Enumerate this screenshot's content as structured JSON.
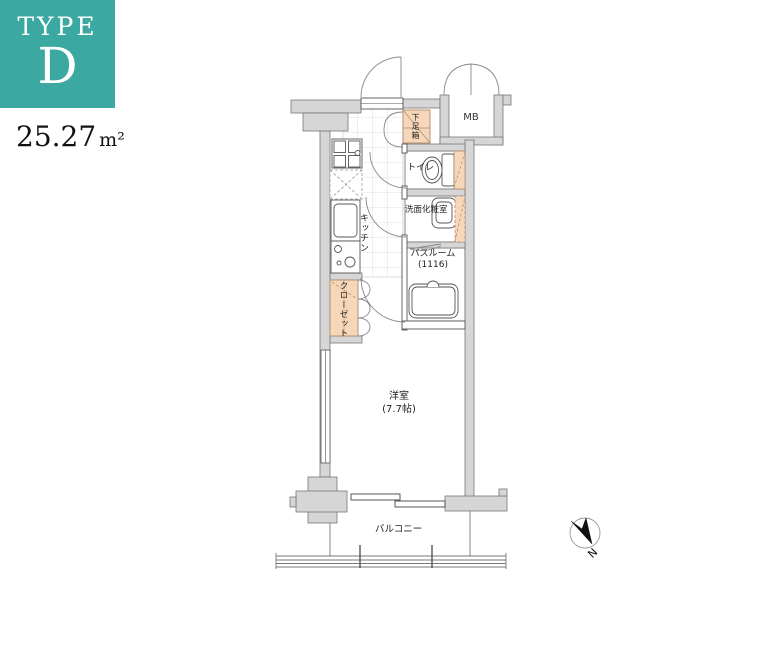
{
  "badge": {
    "type_label": "TYPE",
    "type_letter": "D"
  },
  "area": {
    "value": "25.27",
    "unit": "m²"
  },
  "rooms": {
    "shoe_box": "下足箱",
    "meter_box": "MB",
    "toilet": "トイレ",
    "washroom": "洗面化粧室",
    "kitchen": "キッチン",
    "bathroom_name": "バスルーム",
    "bathroom_size": "(1116)",
    "closet": "クローゼット",
    "main_room_name": "洋室",
    "main_room_size": "(7.7帖)",
    "balcony": "バルコニー"
  },
  "compass": {
    "north_label": "N"
  },
  "colors": {
    "accent_teal": "#3BA9A1",
    "fixture_peach": "#F7D7BA",
    "wall_gray": "#D6D6D6"
  }
}
